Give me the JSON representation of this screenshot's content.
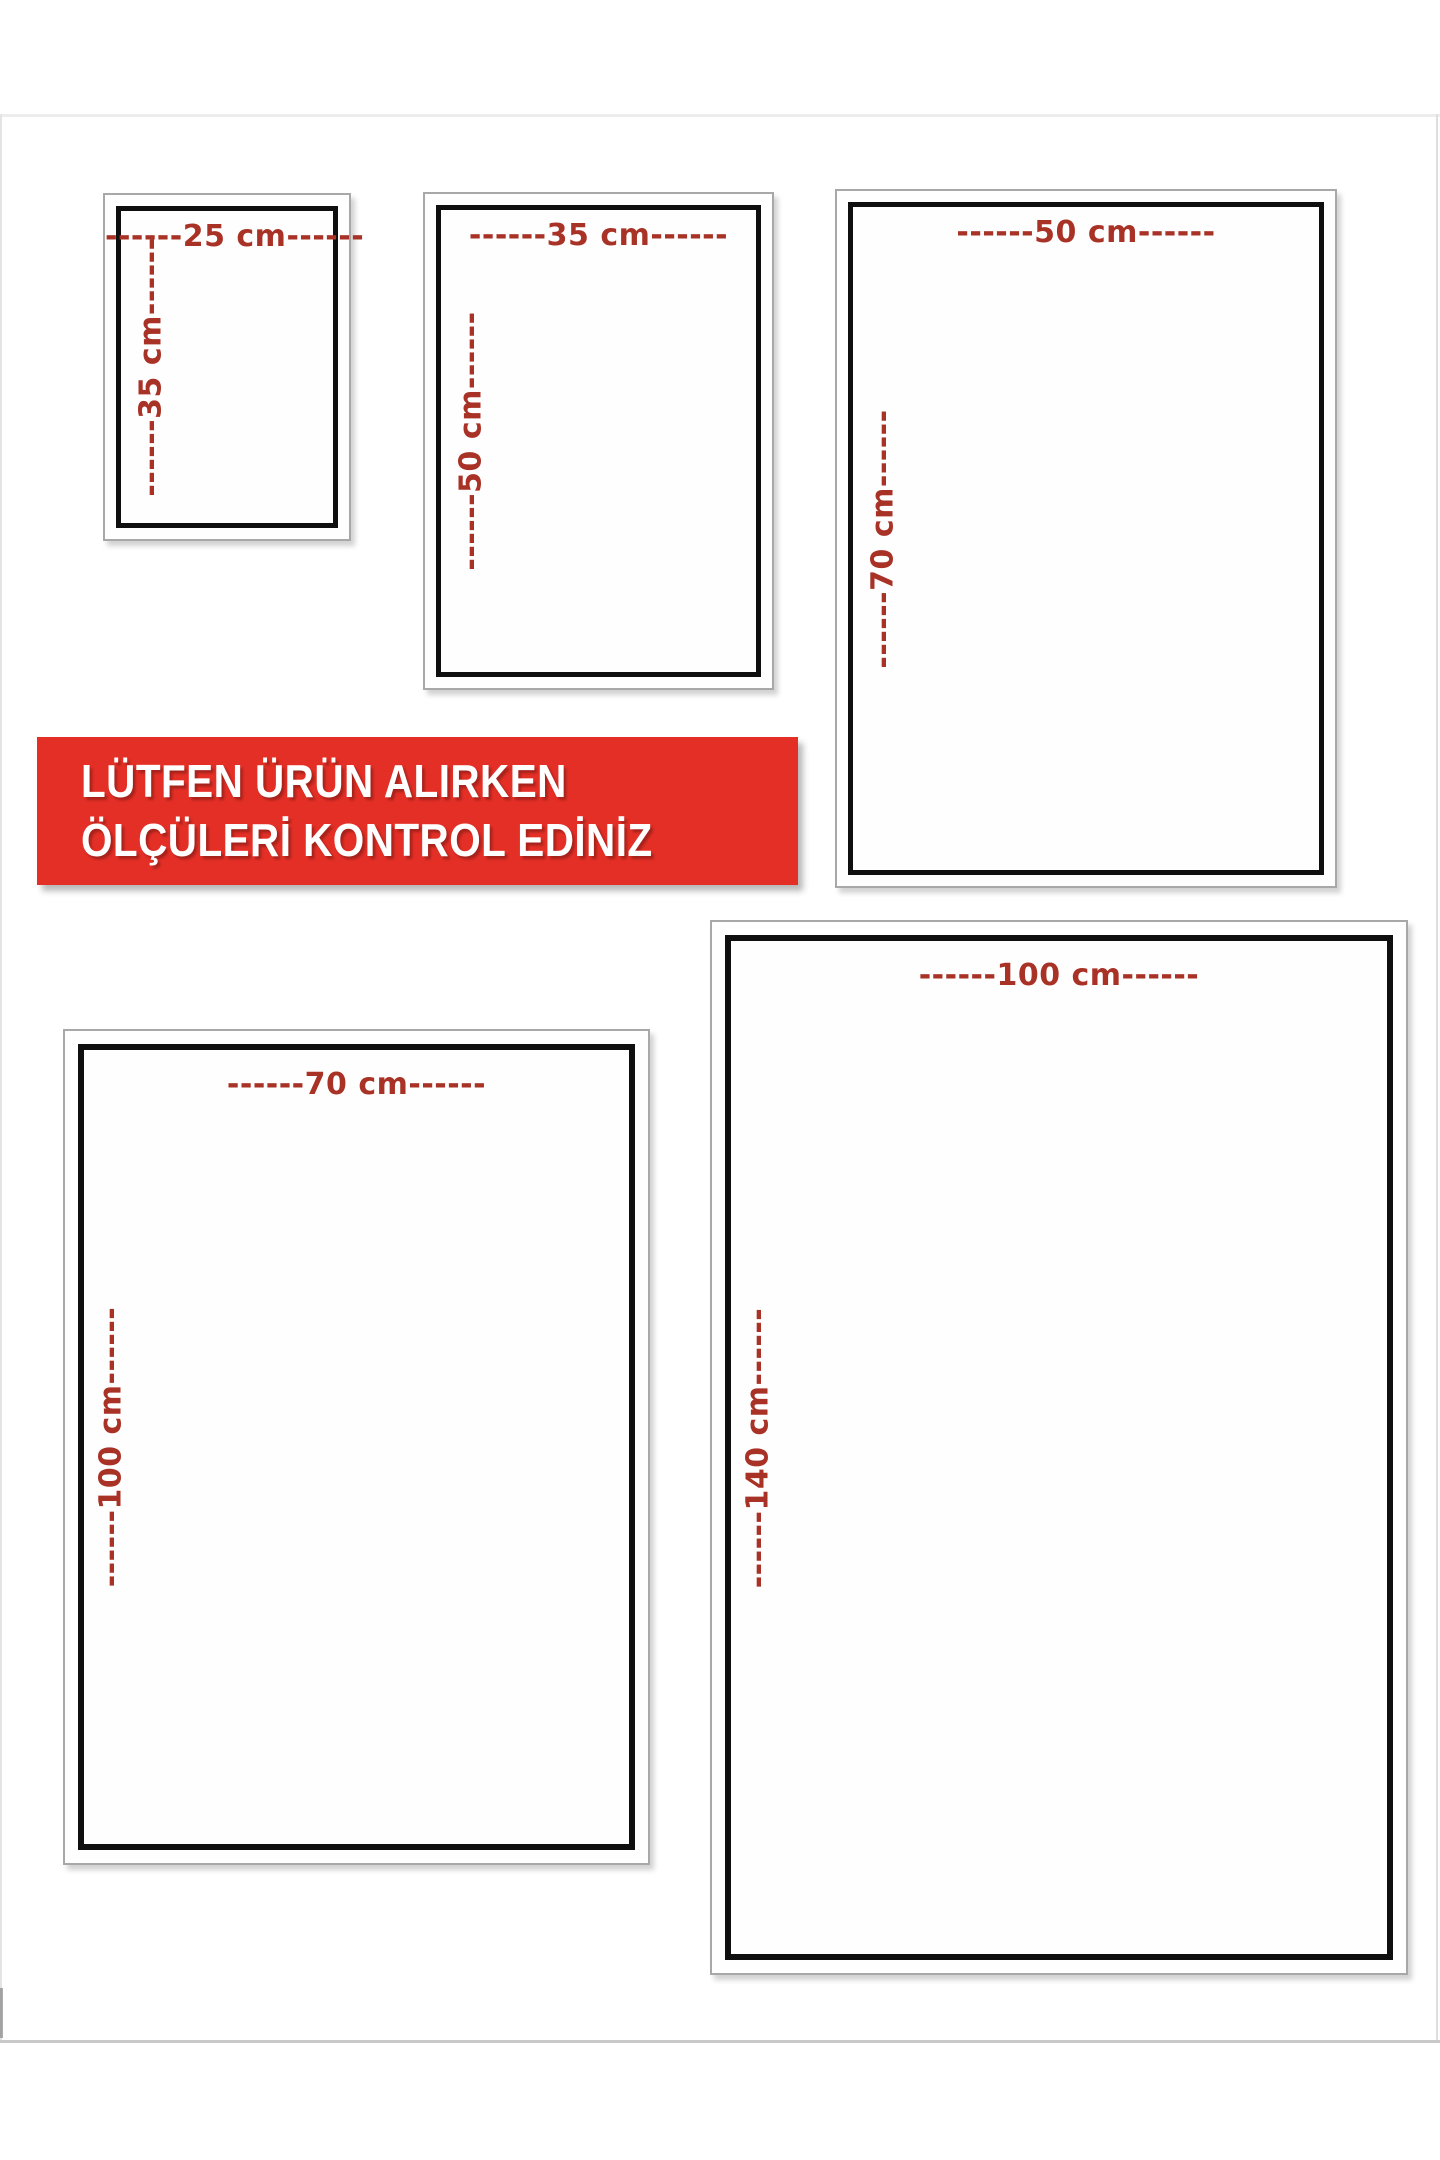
{
  "banner": {
    "line1": "LÜTFEN ÜRÜN ALIRKEN",
    "line2": "ÖLÇÜLERİ KONTROL EDİNİZ",
    "background_color": "#e42f26",
    "text_color": "#ffffff"
  },
  "dimension_label_color": "#a93226",
  "sizes": [
    {
      "width_cm": "25",
      "height_cm": "35",
      "width_label": "------25 cm------",
      "height_label": "------35 cm------"
    },
    {
      "width_cm": "35",
      "height_cm": "50",
      "width_label": "------35 cm------",
      "height_label": "------50 cm------"
    },
    {
      "width_cm": "50",
      "height_cm": "70",
      "width_label": "------50 cm------",
      "height_label": "------70 cm------"
    },
    {
      "width_cm": "70",
      "height_cm": "100",
      "width_label": "------70 cm------",
      "height_label": "------100 cm------"
    },
    {
      "width_cm": "100",
      "height_cm": "140",
      "width_label": "------100 cm------",
      "height_label": "------140 cm------"
    }
  ]
}
